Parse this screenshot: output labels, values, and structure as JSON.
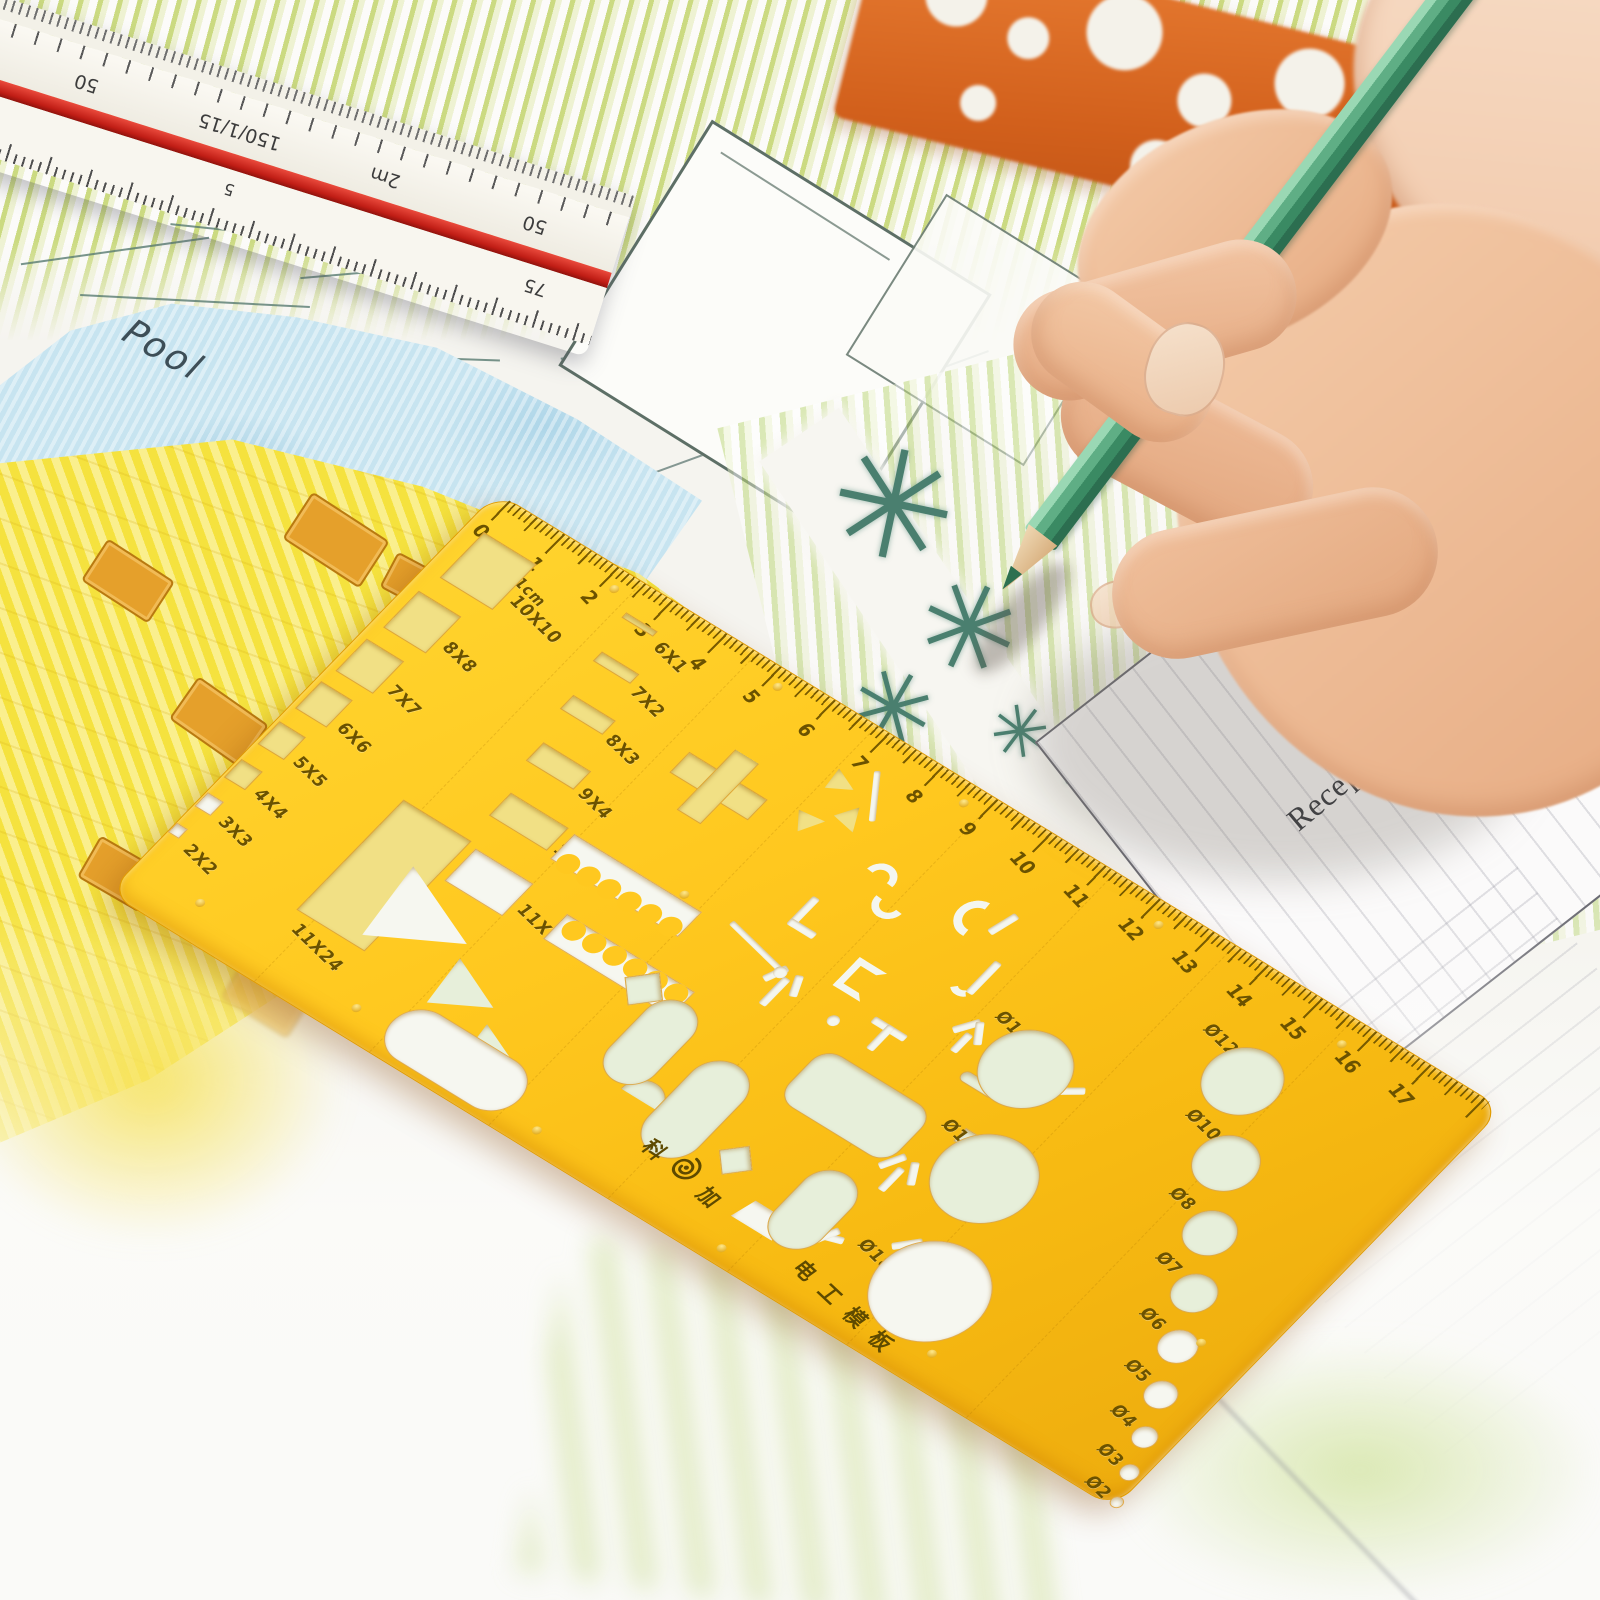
{
  "scale_ruler": {
    "top_face_numbers": [
      "50",
      "150/1/15",
      "2m",
      "50"
    ],
    "bottom_face_numbers": [
      "9",
      "5"
    ],
    "end_label": "75"
  },
  "site_plan": {
    "pool_label": "Pool",
    "reception_label": "Reception"
  },
  "stencil": {
    "brand_prefix": "科",
    "brand_suffix": "加",
    "product_name": "电工模板",
    "cm_label": "1cm",
    "ruler_numbers": [
      "0",
      "1",
      "2",
      "3",
      "4",
      "5",
      "6",
      "7",
      "8",
      "9",
      "10",
      "11",
      "12",
      "13",
      "14",
      "15",
      "16",
      "17"
    ],
    "square_labels": [
      "10X10",
      "8X8",
      "7X7",
      "6X6",
      "5X5",
      "4X4",
      "3X3",
      "2X2"
    ],
    "large_rect_label": "11X24",
    "slot_labels": [
      "6X1",
      "7X2",
      "8X3",
      "9X4",
      "11X5",
      "11X7"
    ],
    "large_circle_labels": [
      "Ø14",
      "Ø16",
      "Ø18"
    ],
    "small_circle_labels": [
      "Ø12",
      "Ø10",
      "Ø8",
      "Ø7",
      "Ø6",
      "Ø5",
      "Ø4",
      "Ø3",
      "Ø2"
    ],
    "colors": {
      "body": "#ffc81f",
      "engraving": "#6b5200",
      "hole_rim": "#e8920a"
    }
  },
  "pencil": {
    "color": "#3f8f68"
  }
}
